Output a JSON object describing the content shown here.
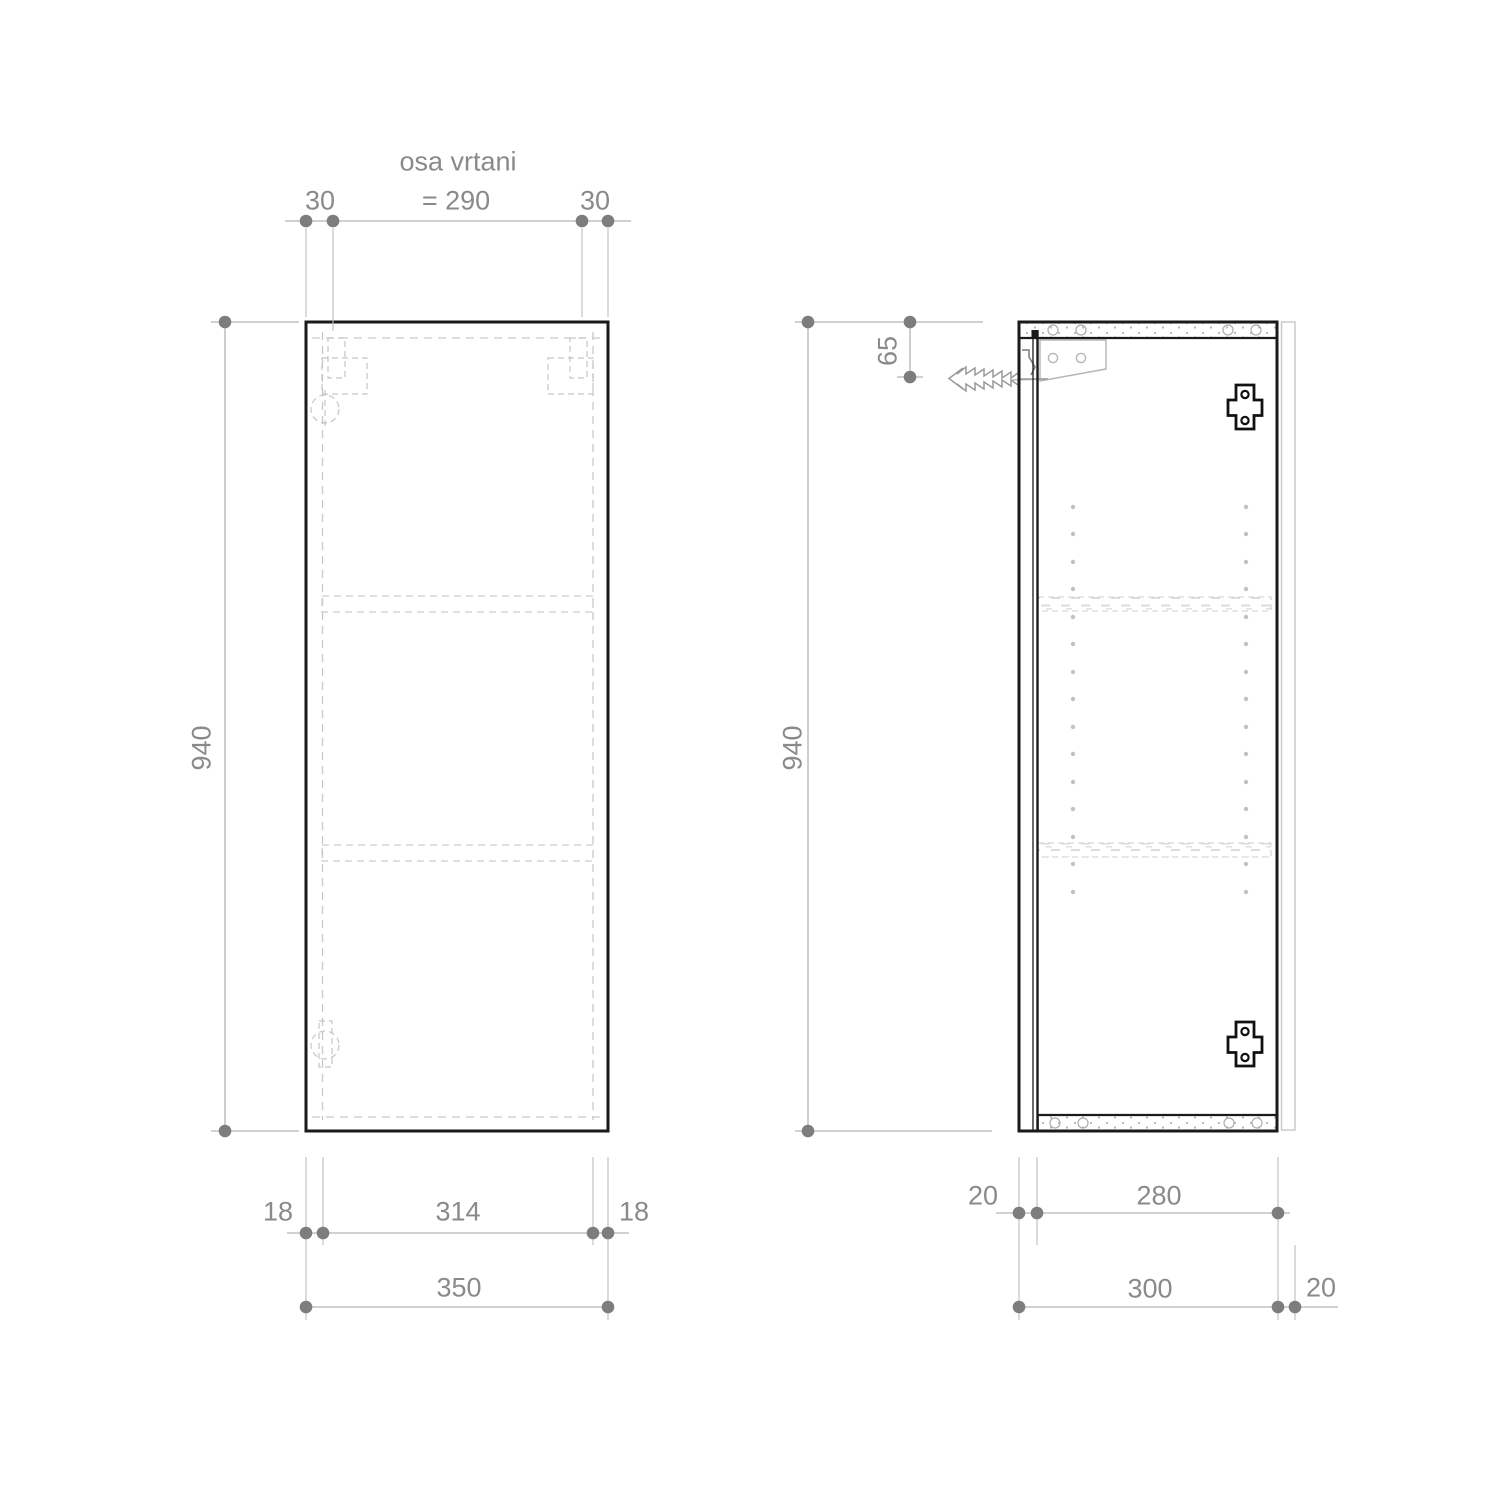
{
  "drawing": {
    "type": "cabinet technical drawing",
    "front_view": {
      "dims": {
        "drill_axis_title": "osa vrtani",
        "drill_axis_value": "= 290",
        "drill_edge_offset_left": "30",
        "drill_edge_offset_right": "30",
        "height": "940",
        "side_thickness_left": "18",
        "inner_width": "314",
        "side_thickness_right": "18",
        "total_width": "350"
      }
    },
    "side_view": {
      "dims": {
        "height": "940",
        "bracket_top_offset": "65",
        "door_thickness": "20",
        "body_depth": "280",
        "depth_with_door": "300",
        "back_offset": "20"
      }
    },
    "colors": {
      "outline": "#1a1a1a",
      "hidden_line": "#c6c6c6",
      "dimension": "#8a8a8a"
    }
  }
}
